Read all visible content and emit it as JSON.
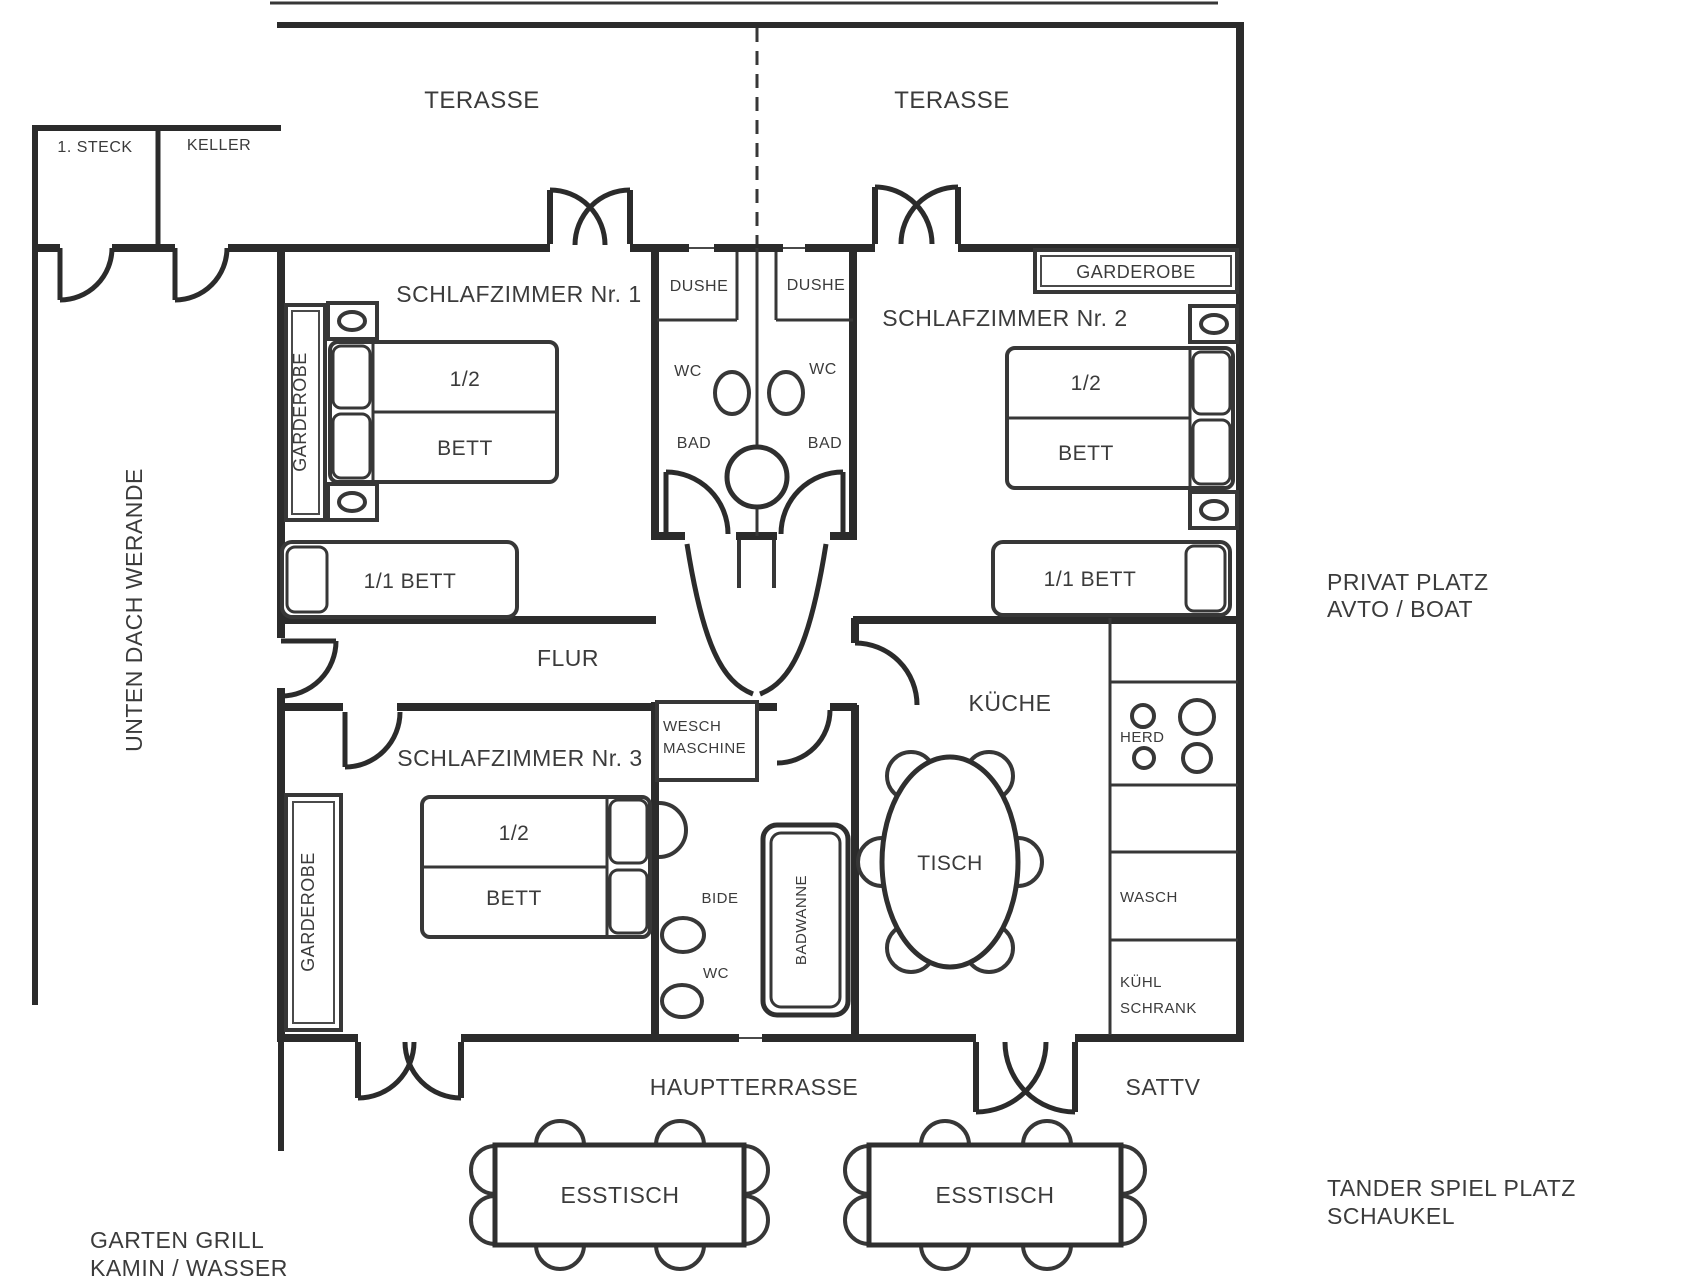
{
  "meta": {
    "type": "floor-plan",
    "wall_color": "#2b2b2b",
    "text_color": "#3b3b3b",
    "bg_color": "#ffffff"
  },
  "outside": {
    "terrace_left": "TERASSE",
    "terrace_right": "TERASSE",
    "veranda": "UNTEN DACH WERANDE",
    "hauptterrasse": "HAUPTTERRASSE",
    "sattv": "SATTV",
    "garten_line1": "GARTEN GRILL",
    "garten_line2": "KAMIN / WASSER",
    "privat_line1": "PRIVAT PLATZ",
    "privat_line2": "AVTO / BOAT",
    "spielplatz_line1": "TANDER SPIEL PLATZ",
    "spielplatz_line2": "SCHAUKEL",
    "esstisch1": "ESSTISCH",
    "esstisch2": "ESSTISCH"
  },
  "entry": {
    "steck": "1. STECK",
    "keller": "KELLER"
  },
  "bedroom1": {
    "name": "SCHLAFZIMMER Nr. 1",
    "garderobe": "GARDEROBE",
    "bed_half": "1/2",
    "bed": "BETT",
    "single_bed": "1/1 BETT"
  },
  "bedroom2": {
    "name": "SCHLAFZIMMER Nr. 2",
    "garderobe": "GARDEROBE",
    "bed_half": "1/2",
    "bed": "BETT",
    "single_bed": "1/1 BETT"
  },
  "bedroom3": {
    "name": "SCHLAFZIMMER Nr. 3",
    "garderobe": "GARDEROBE",
    "bed_half": "1/2",
    "bed": "BETT"
  },
  "bath_left": {
    "dushe": "DUSHE",
    "wc": "WC",
    "bad": "BAD"
  },
  "bath_right": {
    "dushe": "DUSHE",
    "wc": "WC",
    "bad": "BAD"
  },
  "hallway": {
    "flur": "FLUR"
  },
  "bath_lower": {
    "wesch_line1": "WESCH",
    "wesch_line2": "MASCHINE",
    "bide": "BIDE",
    "wc": "WC",
    "badwanne": "BADWANNE"
  },
  "kitchen": {
    "name": "KÜCHE",
    "tisch": "TISCH",
    "herd": "HERD",
    "wasch": "WASCH",
    "kuehl_line1": "KÜHL",
    "kuehl_line2": "SCHRANK"
  }
}
